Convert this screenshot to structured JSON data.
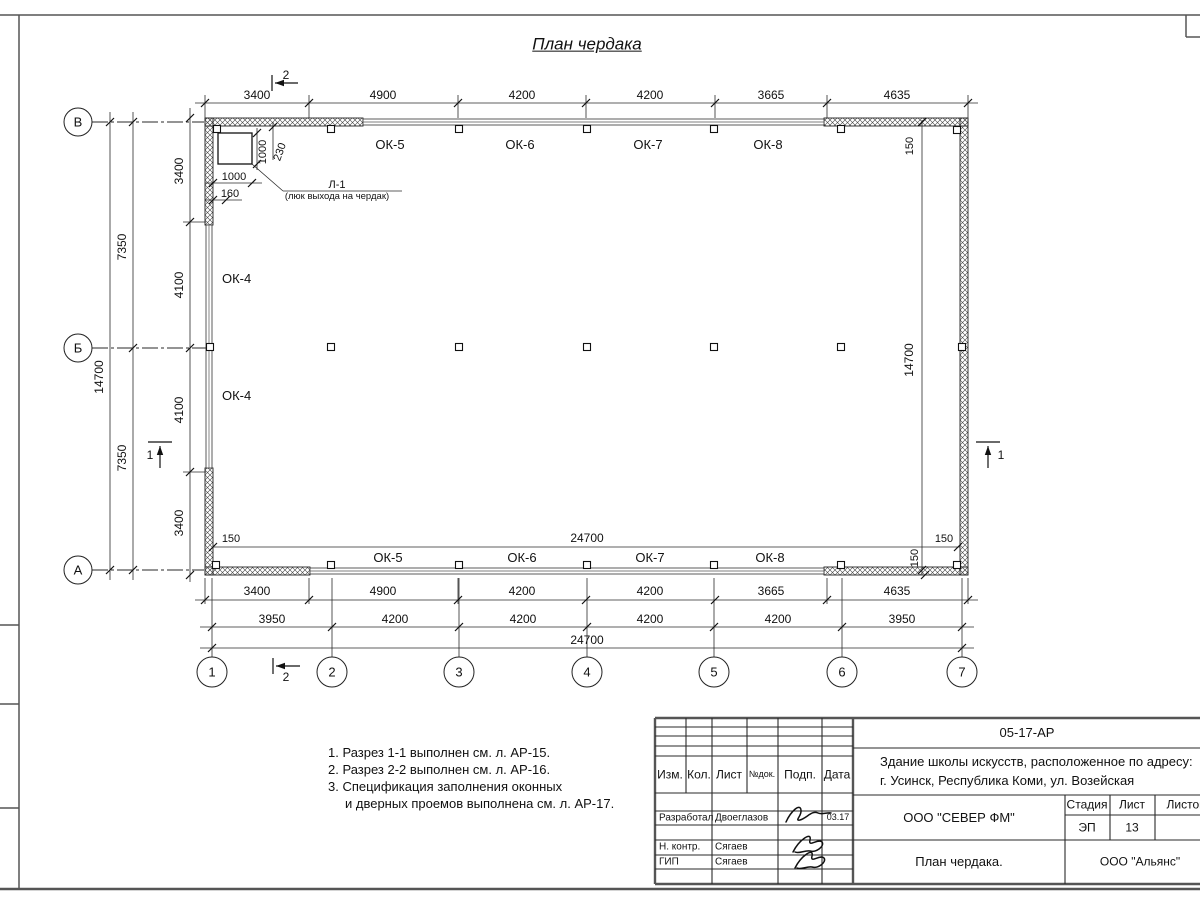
{
  "sheet_title": "План чердака",
  "notes": {
    "n1": "1. Разрез 1-1 выполнен см. л. АР-15.",
    "n2": "2. Разрез 2-2 выполнен см. л. АР-16.",
    "n3": "3. Спецификация заполнения оконных",
    "n4": "и дверных проемов выполнена см. л. АР-17."
  },
  "title_block": {
    "code": "05-17-АР",
    "object_line1": "Здание школы искусств, расположенное по адресу:",
    "object_line2": "г. Усинск, Республика Коми, ул. Возейская",
    "company": "ООО \"СЕВЕР ФМ\"",
    "stage_label": "Стадия",
    "sheet_label": "Лист",
    "sheets_label": "Листов",
    "stage": "ЭП",
    "sheet_number": "13",
    "drawing_title": "План чердака.",
    "firm": "ООО \"Альянс\"",
    "header": [
      "Изм.",
      "Кол.",
      "Лист",
      "№док.",
      "Подп.",
      "Дата"
    ],
    "row1_role": "Разработал",
    "row1_name": "Двоеглазов",
    "row1_date": "03.17",
    "row2_role": "Н. контр.",
    "row2_name": "Сягаев",
    "row3_role": "ГИП",
    "row3_name": "Сягаев"
  },
  "drawing": {
    "hatch": [
      [
        205,
        118,
        158,
        8
      ],
      [
        824,
        118,
        144,
        8
      ],
      [
        205,
        567,
        105,
        8
      ],
      [
        824,
        567,
        144,
        8
      ],
      [
        205,
        118,
        8,
        107
      ],
      [
        205,
        468,
        8,
        107
      ],
      [
        960,
        118,
        8,
        457
      ]
    ],
    "windows": [
      [
        363,
        119,
        461,
        6
      ],
      [
        310,
        568,
        514,
        6
      ],
      [
        206,
        225,
        6,
        243
      ]
    ],
    "luk_rect": [
      218,
      133,
      34,
      31
    ],
    "squares": [
      [
        217,
        129
      ],
      [
        331,
        129
      ],
      [
        459,
        129
      ],
      [
        587,
        129
      ],
      [
        714,
        129
      ],
      [
        841,
        129
      ],
      [
        957,
        130
      ],
      [
        210,
        347
      ],
      [
        331,
        347
      ],
      [
        459,
        347
      ],
      [
        587,
        347
      ],
      [
        714,
        347
      ],
      [
        841,
        347
      ],
      [
        962,
        347
      ],
      [
        216,
        565
      ],
      [
        331,
        565
      ],
      [
        459,
        565
      ],
      [
        587,
        565
      ],
      [
        714,
        565
      ],
      [
        841,
        565
      ],
      [
        957,
        565
      ]
    ],
    "lines": [
      [
        0,
        15,
        1200,
        15,
        "f"
      ],
      [
        19,
        15,
        19,
        889,
        "f"
      ],
      [
        0,
        889,
        1200,
        889,
        "F"
      ],
      [
        1186,
        15,
        1186,
        37,
        "f"
      ],
      [
        1186,
        37,
        1200,
        37,
        "f"
      ],
      [
        0,
        625,
        19,
        625,
        "f"
      ],
      [
        0,
        704,
        19,
        704,
        "f"
      ],
      [
        0,
        808,
        19,
        808,
        "f"
      ],
      [
        195,
        103,
        978,
        103,
        "t"
      ],
      [
        195,
        600,
        978,
        600,
        "t"
      ],
      [
        200,
        627,
        974,
        627,
        "t"
      ],
      [
        200,
        648,
        974,
        648,
        "t"
      ],
      [
        110,
        112,
        110,
        580,
        "t"
      ],
      [
        133,
        112,
        133,
        580,
        "t"
      ],
      [
        190,
        108,
        190,
        582,
        "t"
      ],
      [
        922,
        120,
        922,
        575,
        "t"
      ],
      [
        213,
        547,
        960,
        547,
        "t"
      ],
      [
        205,
        95,
        205,
        118,
        "t"
      ],
      [
        309,
        95,
        309,
        118,
        "t"
      ],
      [
        458,
        95,
        458,
        118,
        "t"
      ],
      [
        586,
        95,
        586,
        118,
        "t"
      ],
      [
        715,
        95,
        715,
        118,
        "t"
      ],
      [
        827,
        95,
        827,
        118,
        "t"
      ],
      [
        968,
        95,
        968,
        118,
        "t"
      ],
      [
        212,
        578,
        212,
        658,
        "t"
      ],
      [
        332,
        578,
        332,
        658,
        "t"
      ],
      [
        459,
        578,
        459,
        658,
        "t"
      ],
      [
        587,
        578,
        587,
        658,
        "t"
      ],
      [
        714,
        578,
        714,
        658,
        "t"
      ],
      [
        842,
        578,
        842,
        658,
        "t"
      ],
      [
        962,
        578,
        962,
        658,
        "t"
      ],
      [
        205,
        578,
        205,
        604,
        "t"
      ],
      [
        309,
        578,
        309,
        604,
        "t"
      ],
      [
        458,
        578,
        458,
        604,
        "t"
      ],
      [
        827,
        578,
        827,
        604,
        "t"
      ],
      [
        968,
        578,
        968,
        604,
        "t"
      ],
      [
        183,
        222,
        206,
        222,
        "t"
      ],
      [
        183,
        472,
        206,
        472,
        "t"
      ],
      [
        92,
        122,
        204,
        122,
        "a"
      ],
      [
        92,
        348,
        208,
        348,
        "a"
      ],
      [
        92,
        570,
        204,
        570,
        "a"
      ],
      [
        257,
        128,
        257,
        170,
        "t"
      ],
      [
        273,
        122,
        273,
        160,
        "t"
      ],
      [
        205,
        183,
        262,
        183,
        "t"
      ],
      [
        205,
        200,
        242,
        200,
        "t"
      ],
      [
        252,
        164,
        283,
        191,
        "t"
      ],
      [
        283,
        191,
        402,
        191,
        "t"
      ],
      [
        655,
        718,
        1200,
        718,
        "F"
      ],
      [
        655,
        718,
        655,
        884,
        "F"
      ],
      [
        655,
        884,
        1200,
        884,
        "F"
      ],
      [
        853,
        718,
        853,
        884,
        "F"
      ],
      [
        712,
        718,
        712,
        884,
        "m"
      ],
      [
        778,
        718,
        778,
        884,
        "m"
      ],
      [
        822,
        718,
        822,
        884,
        "m"
      ],
      [
        686,
        718,
        686,
        793,
        "m"
      ],
      [
        747,
        718,
        747,
        793,
        "m"
      ],
      [
        655,
        727,
        853,
        727,
        "m"
      ],
      [
        655,
        736,
        853,
        736,
        "m"
      ],
      [
        655,
        746,
        853,
        746,
        "m"
      ],
      [
        655,
        756,
        853,
        756,
        "m"
      ],
      [
        655,
        793,
        853,
        793,
        "m"
      ],
      [
        655,
        811,
        853,
        811,
        "m"
      ],
      [
        655,
        825,
        853,
        825,
        "m"
      ],
      [
        655,
        840,
        853,
        840,
        "m"
      ],
      [
        655,
        855,
        853,
        855,
        "m"
      ],
      [
        655,
        869,
        853,
        869,
        "m"
      ],
      [
        853,
        748,
        1200,
        748,
        "m"
      ],
      [
        853,
        795,
        1200,
        795,
        "m"
      ],
      [
        853,
        840,
        1200,
        840,
        "m"
      ],
      [
        1065,
        795,
        1065,
        884,
        "m"
      ],
      [
        1110,
        795,
        1110,
        840,
        "m"
      ],
      [
        1155,
        795,
        1155,
        840,
        "m"
      ],
      [
        1065,
        815,
        1200,
        815,
        "m"
      ]
    ],
    "ticks": [
      [
        205,
        103
      ],
      [
        309,
        103
      ],
      [
        458,
        103
      ],
      [
        586,
        103
      ],
      [
        715,
        103
      ],
      [
        827,
        103
      ],
      [
        968,
        103
      ],
      [
        205,
        600
      ],
      [
        309,
        600
      ],
      [
        458,
        600
      ],
      [
        586,
        600
      ],
      [
        715,
        600
      ],
      [
        827,
        600
      ],
      [
        968,
        600
      ],
      [
        212,
        627
      ],
      [
        332,
        627
      ],
      [
        459,
        627
      ],
      [
        587,
        627
      ],
      [
        714,
        627
      ],
      [
        842,
        627
      ],
      [
        962,
        627
      ],
      [
        212,
        648
      ],
      [
        962,
        648
      ],
      [
        110,
        122
      ],
      [
        110,
        570
      ],
      [
        133,
        122
      ],
      [
        133,
        348
      ],
      [
        133,
        570
      ],
      [
        190,
        118
      ],
      [
        190,
        222
      ],
      [
        190,
        348
      ],
      [
        190,
        472
      ],
      [
        190,
        575
      ],
      [
        922,
        122
      ],
      [
        922,
        570
      ],
      [
        213,
        547
      ],
      [
        958,
        547
      ],
      [
        925,
        575
      ],
      [
        257,
        133
      ],
      [
        257,
        164
      ],
      [
        273,
        127
      ],
      [
        213,
        183
      ],
      [
        252,
        183
      ],
      [
        213,
        200
      ],
      [
        226,
        200
      ]
    ],
    "texts": [
      [
        "3400",
        257,
        99
      ],
      [
        "4900",
        383,
        99
      ],
      [
        "4200",
        522,
        99
      ],
      [
        "4200",
        650,
        99
      ],
      [
        "3665",
        771,
        99
      ],
      [
        "4635",
        897,
        99
      ],
      [
        "3400",
        257,
        595
      ],
      [
        "4900",
        383,
        595
      ],
      [
        "4200",
        522,
        595
      ],
      [
        "4200",
        650,
        595
      ],
      [
        "3665",
        771,
        595
      ],
      [
        "4635",
        897,
        595
      ],
      [
        "3950",
        272,
        623
      ],
      [
        "4200",
        395,
        623
      ],
      [
        "4200",
        523,
        623
      ],
      [
        "4200",
        650,
        623
      ],
      [
        "4200",
        778,
        623
      ],
      [
        "3950",
        902,
        623
      ],
      [
        "24700",
        587,
        644
      ],
      [
        "150",
        231,
        542,
        0,
        11
      ],
      [
        "24700",
        587,
        542
      ],
      [
        "150",
        944,
        542,
        0,
        11
      ],
      [
        "150",
        918,
        558,
        -90,
        11
      ],
      [
        "150",
        913,
        146,
        -90,
        11
      ],
      [
        "14700",
        913,
        360,
        -90,
        12
      ],
      [
        "14700",
        103,
        377,
        -90
      ],
      [
        "7350",
        126,
        247,
        -90
      ],
      [
        "7350",
        126,
        458,
        -90
      ],
      [
        "3400",
        183,
        171,
        -90
      ],
      [
        "4100",
        183,
        285,
        -90
      ],
      [
        "4100",
        183,
        410,
        -90
      ],
      [
        "3400",
        183,
        523,
        -90
      ],
      [
        "ОК-5",
        390,
        149,
        0,
        13
      ],
      [
        "ОК-6",
        520,
        149,
        0,
        13
      ],
      [
        "ОК-7",
        648,
        149,
        0,
        13
      ],
      [
        "ОК-8",
        768,
        149,
        0,
        13
      ],
      [
        "ОК-5",
        388,
        562,
        0,
        13
      ],
      [
        "ОК-6",
        522,
        562,
        0,
        13
      ],
      [
        "ОК-7",
        650,
        562,
        0,
        13
      ],
      [
        "ОК-8",
        770,
        562,
        0,
        13
      ],
      [
        "ОК-4",
        222,
        283,
        0,
        13,
        "start"
      ],
      [
        "ОК-4",
        222,
        400,
        0,
        13,
        "start"
      ],
      [
        "1000",
        266,
        152,
        -90,
        11
      ],
      [
        "230",
        283,
        153,
        -70,
        11
      ],
      [
        "1000",
        234,
        180,
        0,
        11
      ],
      [
        "160",
        230,
        197,
        0,
        11
      ],
      [
        "Л-1",
        337,
        188,
        0,
        11
      ],
      [
        "(люк выхода на чердак)",
        337,
        199,
        0,
        9.5
      ],
      [
        "2",
        286,
        79,
        0,
        12
      ],
      [
        "2",
        286,
        681,
        0,
        12
      ],
      [
        "1",
        150,
        459,
        0,
        12
      ],
      [
        "1",
        1001,
        459,
        0,
        12
      ]
    ],
    "row_axes": [
      [
        "В",
        78,
        122
      ],
      [
        "Б",
        78,
        348
      ],
      [
        "А",
        78,
        570
      ]
    ],
    "col_axes": [
      [
        "1",
        212,
        672
      ],
      [
        "2",
        332,
        672
      ],
      [
        "3",
        459,
        672
      ],
      [
        "4",
        587,
        672
      ],
      [
        "5",
        714,
        672
      ],
      [
        "6",
        842,
        672
      ],
      [
        "7",
        962,
        672
      ]
    ],
    "arrows": [
      {
        "line": [
          298,
          83,
          275,
          83
        ],
        "head": [
          275,
          83,
          "left"
        ],
        "tick": [
          272,
          75,
          272,
          91
        ]
      },
      {
        "line": [
          300,
          666,
          276,
          666
        ],
        "head": [
          276,
          666,
          "left"
        ],
        "tick": [
          273,
          658,
          273,
          674
        ]
      },
      {
        "line": [
          160,
          468,
          160,
          446
        ],
        "head": [
          160,
          446,
          "up"
        ],
        "tick": [
          148,
          442,
          172,
          442
        ]
      },
      {
        "line": [
          988,
          468,
          988,
          446
        ],
        "head": [
          988,
          446,
          "up"
        ],
        "tick": [
          976,
          442,
          1000,
          442
        ]
      }
    ],
    "signatures": [
      "M786,822 C791,811 800,803 801,810 C802,816 794,821 800,820 C807,818 812,810 818,813 C822,815 827,812 831,813",
      "M793,852 C799,840 812,831 810,840 C808,848 818,838 822,842 C825,846 816,853 810,851 C805,850 799,854 795,852",
      "M795,868 C801,856 814,847 812,856 C810,864 820,854 824,858 C827,862 818,869 812,867 C807,866 801,870 797,868"
    ]
  }
}
